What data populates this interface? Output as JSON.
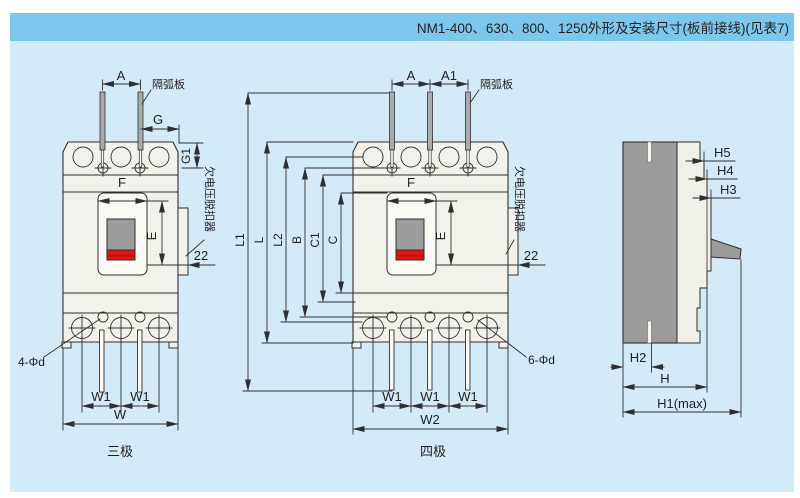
{
  "title": "NM1-400、630、800、1250外形及安装尺寸(板前接线)(见表7)",
  "colors": {
    "title_band": "#7cc8ec",
    "canvas": "#d3eaf7",
    "body_fill": "#f2f1ea",
    "handle_gray": "#9c9c9c",
    "handle_red": "#e41511",
    "side_dark": "#9b9b9a",
    "line": "#2f2f2f"
  },
  "figures": {
    "three_pole": {
      "caption": "三极",
      "dims": {
        "A": "A",
        "G": "G",
        "G1": "G1",
        "F": "F",
        "E": "E",
        "offset": "22",
        "W1a": "W1",
        "W1b": "W1",
        "W": "W"
      },
      "notes": {
        "arc_plate": "隔弧板",
        "uv_release": "欠电压脱扣器",
        "holes": "4-Φd"
      }
    },
    "four_pole": {
      "caption": "四极",
      "dims": {
        "A": "A",
        "A1": "A1",
        "L1": "L1",
        "L": "L",
        "L2": "L2",
        "B": "B",
        "C1": "C1",
        "C": "C",
        "F": "F",
        "E": "E",
        "offset": "22",
        "W1a": "W1",
        "W1b": "W1",
        "W1c": "W1",
        "W2": "W2"
      },
      "notes": {
        "arc_plate": "隔弧板",
        "uv_release": "欠电压脱扣器",
        "holes": "6-Φd"
      }
    },
    "side": {
      "dims": {
        "H5": "H5",
        "H4": "H4",
        "H3": "H3",
        "H2": "H2",
        "H": "H",
        "H1": "H1(max)"
      }
    }
  }
}
